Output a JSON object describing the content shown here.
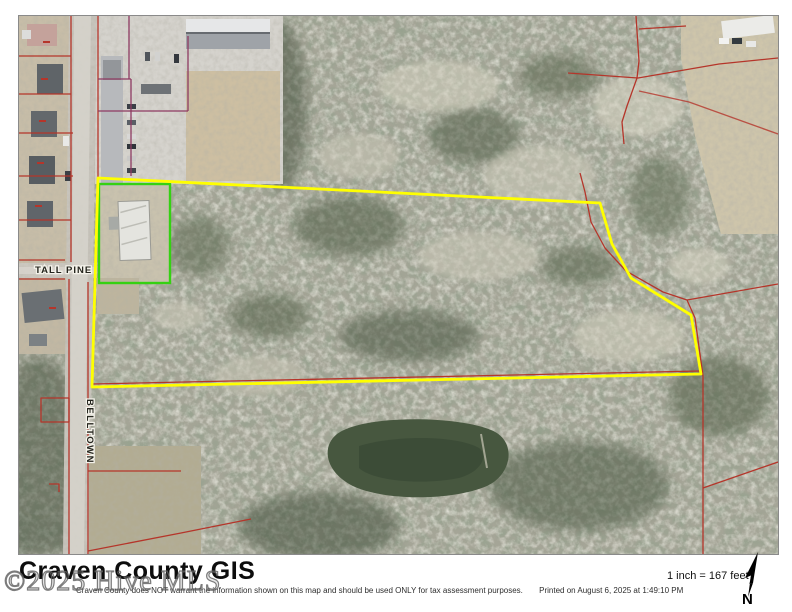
{
  "page": {
    "title": "Craven County GIS",
    "watermark": "©2025 Hive MLS"
  },
  "map": {
    "road_labels": {
      "tall_pine": "TALL PINE",
      "belltown": "BELLTOWN"
    },
    "colors": {
      "subject_parcel_outline": "#ffff00",
      "building_site_outline": "#35d112",
      "parcel_line_red": "#b5352a",
      "parcel_line_purple": "#8e3a62"
    }
  },
  "footer": {
    "disclaimer": "Craven County does NOT warrant the information shown on this map and should be used ONLY for tax assessment purposes.",
    "printed": "Printed on August 6, 2025 at 1:49:10 PM",
    "scale": "1 inch = 167 feet",
    "north_label": "N"
  }
}
